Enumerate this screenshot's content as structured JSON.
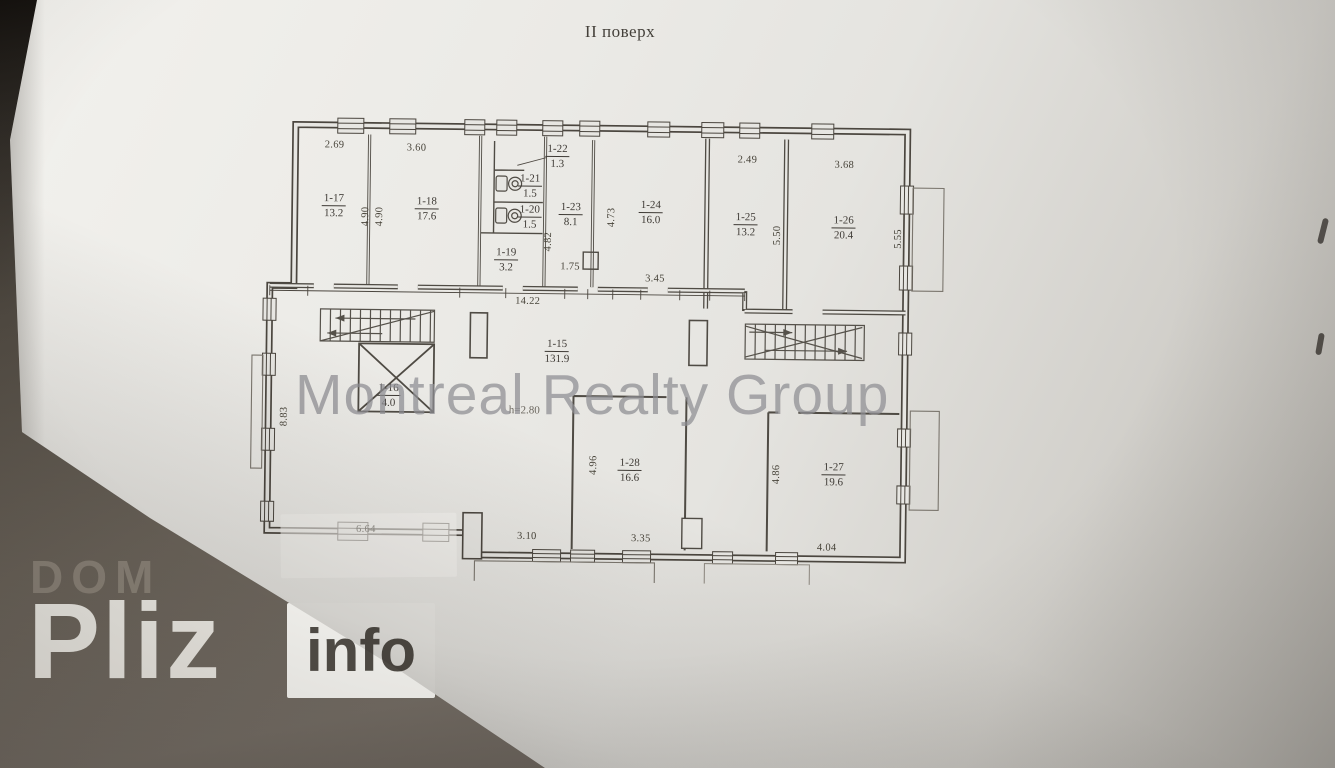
{
  "page": {
    "title": "II поверх",
    "height_note": "h=2.80"
  },
  "watermark": {
    "agency": "Montreal Realty Group"
  },
  "logo": {
    "top": "DOM",
    "main": "Pliz",
    "suffix": "info"
  },
  "plan": {
    "rooms": [
      {
        "number": "1-17",
        "area": "13.2"
      },
      {
        "number": "1-18",
        "area": "17.6"
      },
      {
        "number": "1-22",
        "area": "1.3"
      },
      {
        "number": "1-21",
        "area": "1.5"
      },
      {
        "number": "1-20",
        "area": "1.5"
      },
      {
        "number": "1-19",
        "area": "3.2"
      },
      {
        "number": "1-23",
        "area": "8.1"
      },
      {
        "number": "1-24",
        "area": "16.0"
      },
      {
        "number": "1-25",
        "area": "13.2"
      },
      {
        "number": "1-26",
        "area": "20.4"
      },
      {
        "number": "1-15",
        "area": "131.9"
      },
      {
        "number": "1-16",
        "area": "4.0"
      },
      {
        "number": "1-28",
        "area": "16.6"
      },
      {
        "number": "1-27",
        "area": "19.6"
      }
    ],
    "dims": {
      "r17_width": "2.69",
      "r18_width": "3.60",
      "r25_width": "2.49",
      "r26_width": "3.68",
      "r17_depth": "4.90",
      "r18_depth": "4.90",
      "r23_depth": "4.82",
      "r24_depth": "4.73",
      "r25_depth": "5.50",
      "r26_depth": "5.55",
      "wc_lobby_width": "1.75",
      "r24_width": "3.45",
      "hall_width": "14.22",
      "hall_left_depth": "8.83",
      "r28_depth": "4.96",
      "r27_depth": "4.86",
      "r28_width": "3.35",
      "hall_bottom_width": "3.10",
      "bottom_left_wall": "6.64",
      "r27_width": "4.04"
    }
  },
  "colors": {
    "paper": "#e8e7e3",
    "ink": "#4b463f",
    "watermark_gray": "#8e8e93",
    "table_dark": "#14110e"
  }
}
